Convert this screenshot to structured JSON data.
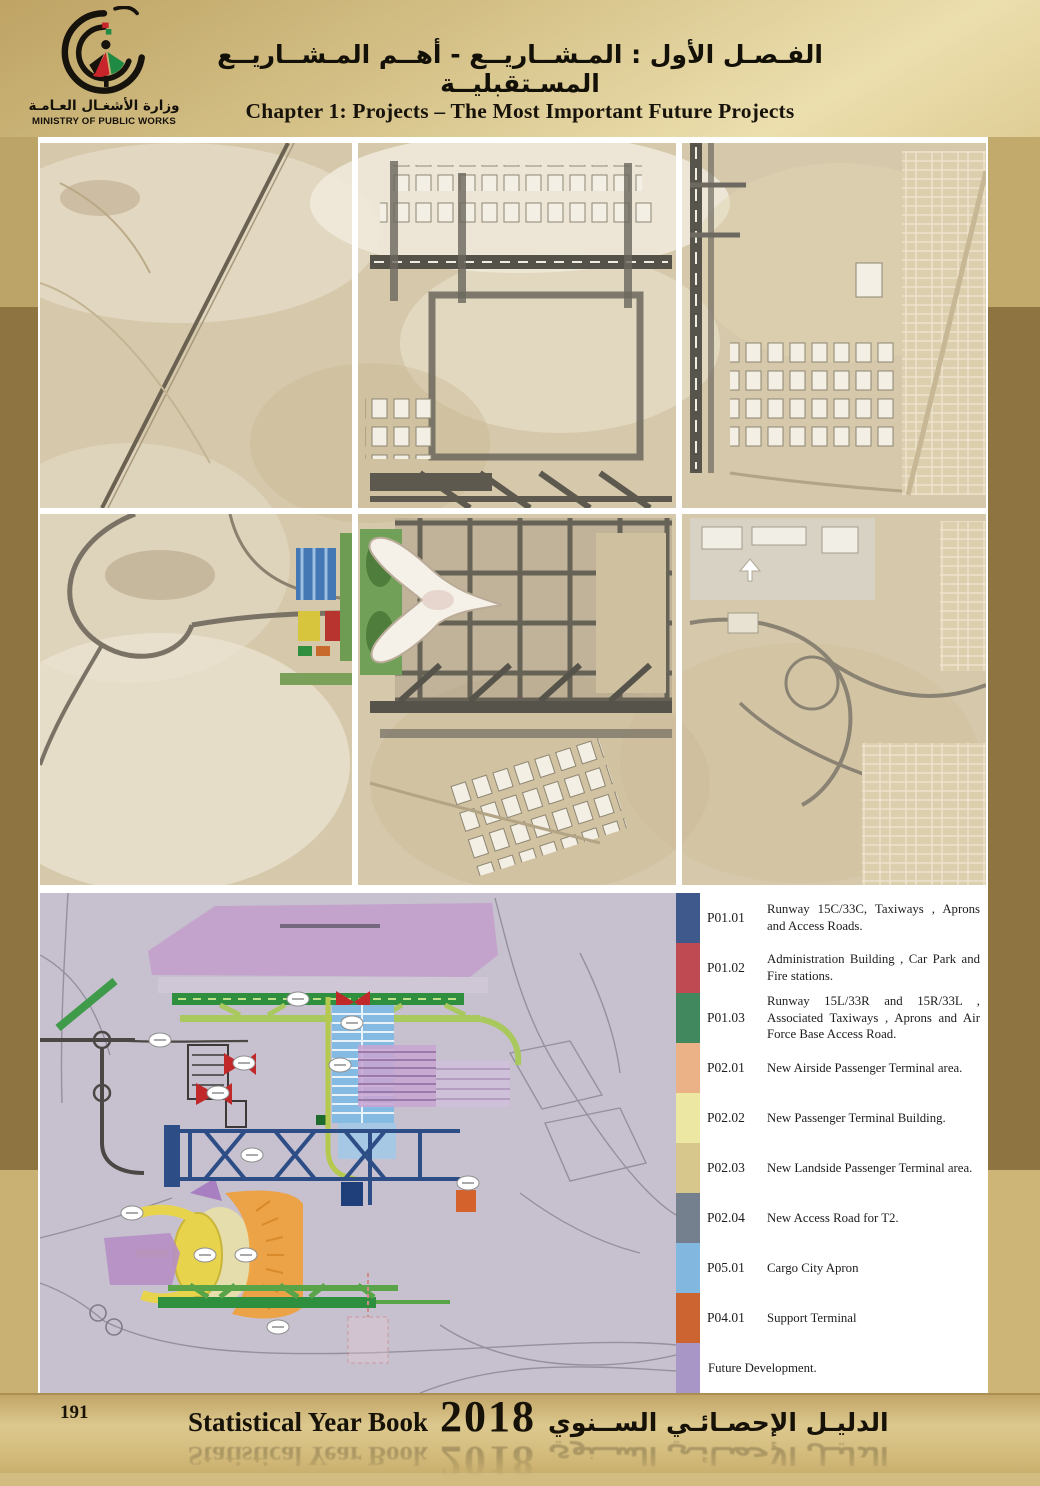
{
  "header": {
    "logo": {
      "arabic_name": "وزارة الأشغـال العـامـة",
      "english_name": "MINISTRY OF PUBLIC WORKS"
    },
    "arabic_title": "الفـصـل الأول : المـشــاريــع - أهــم المـشــاريــع المسـتقبليــة",
    "english_title": "Chapter 1: Projects – The Most Important Future Projects"
  },
  "legend": {
    "items": [
      {
        "code": "P01.01",
        "label": "Runway 15C/33C, Taxiways , Aprons and Access Roads.",
        "color": "#40598c"
      },
      {
        "code": "P01.02",
        "label": "Administration Building , Car Park and Fire stations.",
        "color": "#c04a52"
      },
      {
        "code": "P01.03",
        "label": "Runway 15L/33R and 15R/33L , Associated Taxiways , Aprons and Air Force Base Access Road.",
        "color": "#41885e"
      },
      {
        "code": "P02.01",
        "label": "New Airside Passenger Terminal area.",
        "color": "#eab286"
      },
      {
        "code": "P02.02",
        "label": "New Passenger Terminal Building.",
        "color": "#ece8a3"
      },
      {
        "code": "P02.03",
        "label": "New Landside Passenger Terminal area.",
        "color": "#d7c78c"
      },
      {
        "code": "P02.04",
        "label": "New Access Road for T2.",
        "color": "#75808f"
      },
      {
        "code": "P05.01",
        "label": "Cargo City Apron",
        "color": "#82b8e0"
      },
      {
        "code": "P04.01",
        "label": "Support Terminal",
        "color": "#cb6431"
      },
      {
        "code": "",
        "label": "Future Development.",
        "color": "#a897c6"
      }
    ]
  },
  "footer": {
    "page_number": "191",
    "book_title_en": "Statistical Year Book",
    "year": "2018",
    "book_title_ar": "الدليـل الإحصـائـي الســنوي"
  }
}
